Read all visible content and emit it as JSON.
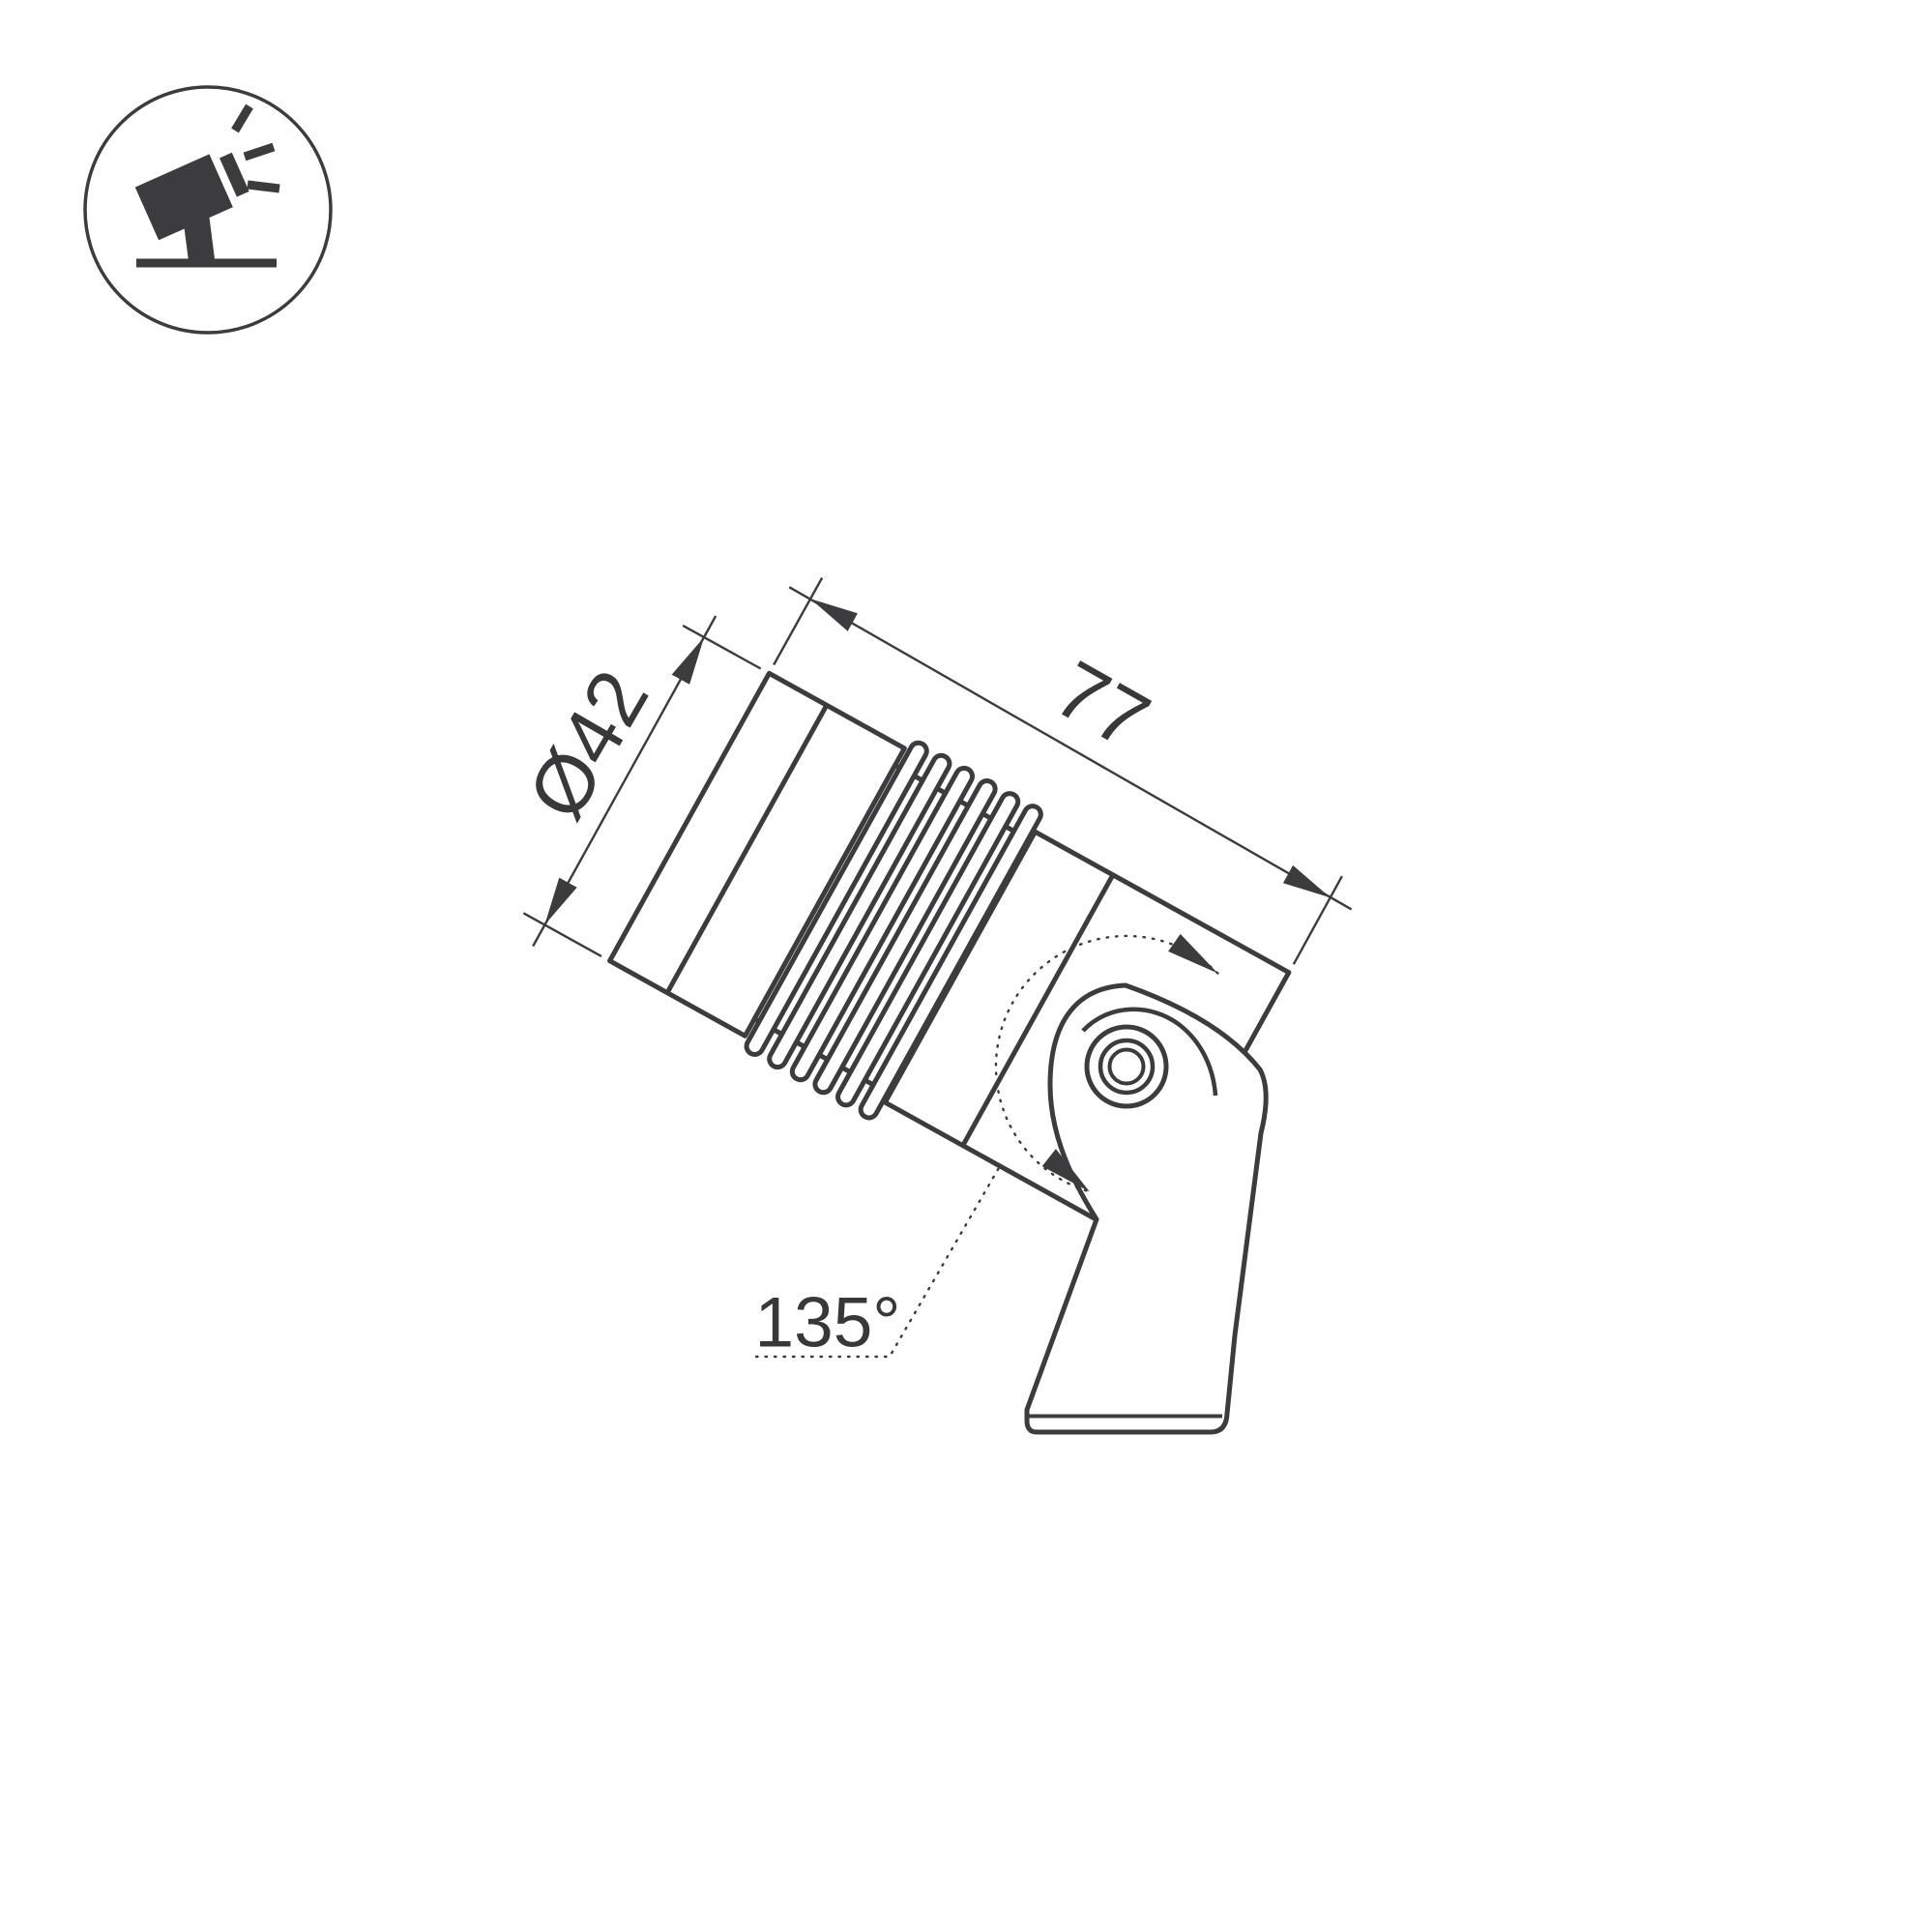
{
  "meta": {
    "background": "#ffffff",
    "line_color": "#3c3c3e",
    "text_color": "#38383a",
    "drawing_type": "technical dimension drawing",
    "subject": "tiltable ground-mount spotlight, side view"
  },
  "icon": {
    "name": "adjustable-spotlight-icon",
    "meaning": "spotlight on ground mount with adjustable tilt"
  },
  "annotations": {
    "diameter": {
      "label": "Ø42",
      "value": 42,
      "unit": "mm",
      "kind": "diameter of lamp head"
    },
    "length": {
      "label": "77",
      "value": 77,
      "unit": "mm",
      "kind": "length of lamp body"
    },
    "rotation": {
      "label": "135°",
      "value": 135,
      "unit": "degrees",
      "kind": "tilt adjustment range around bracket pivot"
    }
  }
}
